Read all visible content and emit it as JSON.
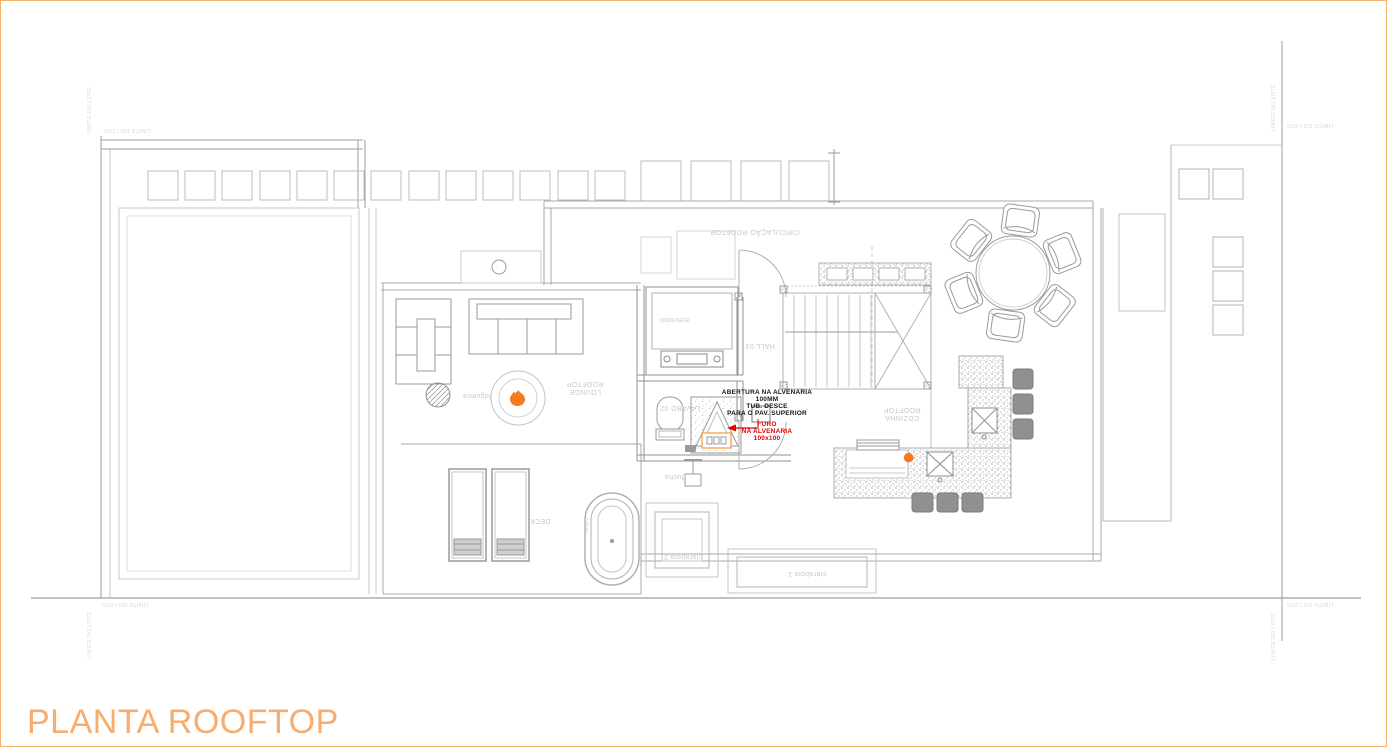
{
  "drawing": {
    "title": "PLANTA ROOFTOP",
    "boundary_label": "LIMITE DO LOTE",
    "labels": {
      "circulacao": "CIRCULAÇÃO ROOFTOP",
      "lounge": "LOUNGE\nROOFTOP",
      "cozinha": "COZINHA\nROOFTOP",
      "hall": "HALL 03",
      "lavabo": "LAVABO 02",
      "elevador": "elevador",
      "deck": "DECK",
      "fogueira": "fogueira",
      "ofuro": "ofurô",
      "ducha": "ducha",
      "claraboia_1": "claraboia 1",
      "claraboia_2": "claraboia 2"
    },
    "annotation": {
      "black": "ABERTURA NA ALVENARIA\n100MM\nTUB. DESCE\nPARA O PAV. SUPERIOR",
      "red": "FURO\nNA ALVENARIA\n100x100"
    },
    "colors": {
      "title_orange": "#F8AD6E",
      "border_orange": "#EFB468",
      "flame_orange": "#F47B20",
      "highlight_orange": "#F29A38",
      "annotation_red": "#E60000",
      "line_gray": "#ABABAB"
    }
  }
}
